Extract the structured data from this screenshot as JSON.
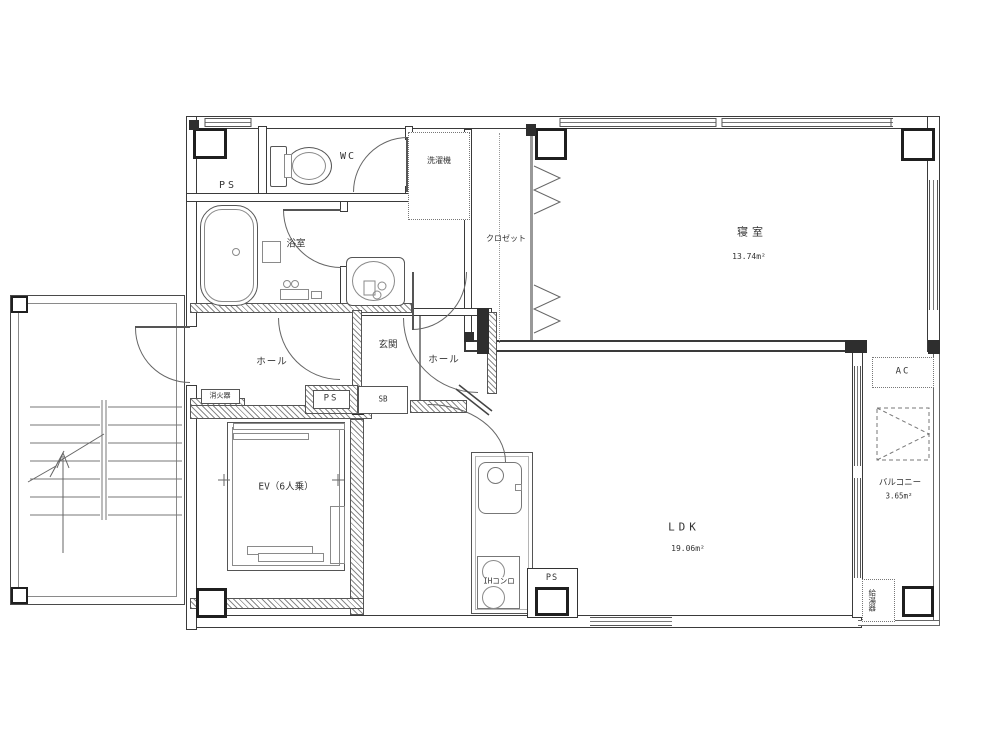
{
  "plan_title": "apartment-floor-plan",
  "labels": {
    "ps_top": "PS",
    "wc": "WC",
    "washing_machine": "洗濯機",
    "bathroom": "浴室",
    "closet": "クロゼット",
    "bedroom": "寝室",
    "bedroom_area": "13.74m²",
    "hall_left": "ホール",
    "entrance": "玄関",
    "hall_right": "ホール",
    "ps_mid": "PS",
    "shoe_box": "SB",
    "fire_extinguisher": "消火器",
    "elevator": "EV（6人乗）",
    "ih_stove": "IHコンロ",
    "ps_bottom": "PS",
    "ldk": "LDK",
    "ldk_area": "19.06m²",
    "ac": "AC",
    "balcony": "バルコニー",
    "balcony_area": "3.65m²",
    "water_heater": "給湯器"
  },
  "colors": {
    "wall_line": "#3a3a3a",
    "fixture_line": "#8a8a8a",
    "text": "#333333",
    "background": "#ffffff"
  }
}
